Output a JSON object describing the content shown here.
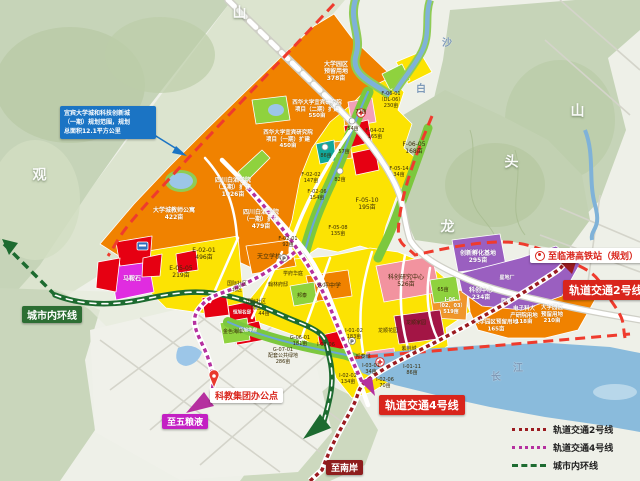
{
  "callout": {
    "text": "宜宾大学城和科技创新城\n（一期）规划范围，规划\n总面积12.1平方公里"
  },
  "labels": {
    "inner_ring": "城市内环线",
    "to_hsr": "至临港高铁站（规划）",
    "line2": "轨道交通2号线",
    "line4": "轨道交通4号线",
    "keji_office": "科教集团办公点",
    "to_wuliangye": "至五粮液",
    "to_nanan": "至南岸"
  },
  "legend": {
    "items": [
      {
        "label": "轨道交通2号线",
        "color": "#9b1b20",
        "style": "dotted"
      },
      {
        "label": "轨道交通4号线",
        "color": "#b5309f",
        "style": "dotted"
      },
      {
        "label": "城市内环线",
        "color": "#1d6b30",
        "style": "dashed"
      }
    ]
  },
  "map": {
    "labels_on_map": [
      {
        "t": "山",
        "x": 240,
        "y": 14,
        "c": "t"
      },
      {
        "t": "观",
        "x": 40,
        "y": 176,
        "c": "t"
      },
      {
        "t": "山",
        "x": 578,
        "y": 112,
        "c": "t"
      },
      {
        "t": "头",
        "x": 512,
        "y": 163,
        "c": "t"
      },
      {
        "t": "龙",
        "x": 448,
        "y": 228,
        "c": "t"
      },
      {
        "t": "沙",
        "x": 447,
        "y": 44,
        "c": "t2"
      },
      {
        "t": "白",
        "x": 421,
        "y": 90,
        "c": "t2"
      },
      {
        "t": "长",
        "x": 496,
        "y": 378,
        "c": "t2"
      },
      {
        "t": "江",
        "x": 518,
        "y": 369,
        "c": "t2"
      },
      {
        "t": "大学园区\n预留用地\n378亩",
        "x": 336,
        "y": 72,
        "c": "w"
      },
      {
        "t": "西华大学宜宾研究院\n项目（二期）扩建\n550亩",
        "x": 317,
        "y": 110,
        "c": "w",
        "fs": 5.5
      },
      {
        "t": "西华大学宜宾研究院\n项目（一期）扩建\n450亩",
        "x": 288,
        "y": 140,
        "c": "w",
        "fs": 5.5
      },
      {
        "t": "四川白酒学院\n（二期）扩建\n1026亩",
        "x": 233,
        "y": 188,
        "c": "w"
      },
      {
        "t": "大学城教师公寓\n422亩",
        "x": 174,
        "y": 214,
        "c": "w"
      },
      {
        "t": "四川白酒学院\n（一期）扩建\n479亩",
        "x": 261,
        "y": 220,
        "c": "w"
      },
      {
        "t": "电子科大\n产研院用地\n118亩",
        "x": 524,
        "y": 316,
        "c": "w",
        "fs": 5.5
      },
      {
        "t": "大学园区\n预留用地\n210亩",
        "x": 552,
        "y": 315,
        "c": "w",
        "fs": 5.5
      },
      {
        "t": "大学园区预留用地\n165亩",
        "x": 496,
        "y": 326,
        "c": "w",
        "fs": 5.5
      },
      {
        "t": "创新孵化基地\n295亩",
        "x": 478,
        "y": 257,
        "c": "w"
      },
      {
        "t": "科创中心\n234亩",
        "x": 481,
        "y": 294,
        "c": "w"
      },
      {
        "t": "星地厂",
        "x": 507,
        "y": 278,
        "c": "w",
        "fs": 5
      },
      {
        "t": "西元",
        "x": 506,
        "y": 301,
        "c": "w",
        "fs": 5
      },
      {
        "t": "马鞍石",
        "x": 132,
        "y": 279,
        "c": "w"
      },
      {
        "t": "恒旭名邸",
        "x": 242,
        "y": 313,
        "c": "w",
        "fs": 4.5
      },
      {
        "t": "恒旭华府",
        "x": 248,
        "y": 331,
        "c": "w",
        "fs": 4.5
      },
      {
        "t": "I-06-\n（02、03）\n519亩",
        "x": 451,
        "y": 306,
        "c": "w",
        "fs": 5
      },
      {
        "t": "天立学校",
        "x": 269,
        "y": 257,
        "c": "d"
      },
      {
        "t": "沙坪中学",
        "x": 329,
        "y": 286,
        "c": "d"
      },
      {
        "t": "学府华庭",
        "x": 293,
        "y": 274,
        "c": "d",
        "fs": 5
      },
      {
        "t": "翰林府邸",
        "x": 278,
        "y": 285,
        "c": "d",
        "fs": 5
      },
      {
        "t": "国际社区\n北区",
        "x": 237,
        "y": 287,
        "c": "d",
        "fs": 5
      },
      {
        "t": "国际社区\n南区",
        "x": 256,
        "y": 305,
        "c": "d",
        "fs": 5
      },
      {
        "t": "44亩",
        "x": 264,
        "y": 314,
        "c": "d",
        "fs": 5
      },
      {
        "t": "邦泰",
        "x": 302,
        "y": 296,
        "c": "d",
        "fs": 5
      },
      {
        "t": "金色海岸",
        "x": 233,
        "y": 332,
        "c": "d",
        "fs": 5
      },
      {
        "t": "E-05-05\n219亩",
        "x": 181,
        "y": 272,
        "c": "d"
      },
      {
        "t": "E-02-01\n496亩",
        "x": 204,
        "y": 254,
        "c": "d"
      },
      {
        "t": "F-02-02\n147亩",
        "x": 311,
        "y": 178,
        "c": "d",
        "fs": 5
      },
      {
        "t": "F-02-06\n154亩",
        "x": 317,
        "y": 195,
        "c": "d",
        "fs": 5
      },
      {
        "t": "F-02-01\n92亩",
        "x": 288,
        "y": 242,
        "c": "d",
        "fs": 5
      },
      {
        "t": "F-04-02\n165亩",
        "x": 375,
        "y": 134,
        "c": "d",
        "fs": 5
      },
      {
        "t": "F-06-01\n（DL-06）\n230亩",
        "x": 391,
        "y": 100,
        "c": "d",
        "fs": 5
      },
      {
        "t": "F-06-05\n168亩",
        "x": 414,
        "y": 148,
        "c": "d"
      },
      {
        "t": "F-05-14\n34亩",
        "x": 399,
        "y": 172,
        "c": "d",
        "fs": 5
      },
      {
        "t": "F-05-10\n195亩",
        "x": 367,
        "y": 204,
        "c": "d"
      },
      {
        "t": "F-05-08\n135亩",
        "x": 338,
        "y": 231,
        "c": "d",
        "fs": 5
      },
      {
        "t": "71亩",
        "x": 361,
        "y": 112,
        "c": "d",
        "fs": 5
      },
      {
        "t": "54亩",
        "x": 353,
        "y": 129,
        "c": "d",
        "fs": 5
      },
      {
        "t": "57亩",
        "x": 344,
        "y": 152,
        "c": "d",
        "fs": 5
      },
      {
        "t": "86亩",
        "x": 326,
        "y": 156,
        "c": "d",
        "fs": 5
      },
      {
        "t": "82亩",
        "x": 340,
        "y": 180,
        "c": "d",
        "fs": 5
      },
      {
        "t": "科创研究中心\n526亩",
        "x": 406,
        "y": 281,
        "c": "d"
      },
      {
        "t": "65亩",
        "x": 443,
        "y": 290,
        "c": "d",
        "fs": 5
      },
      {
        "t": "龙顺家园",
        "x": 416,
        "y": 323,
        "c": "d",
        "fs": 5
      },
      {
        "t": "龙顺花园",
        "x": 388,
        "y": 331,
        "c": "d",
        "fs": 5
      },
      {
        "t": "紫荆城",
        "x": 409,
        "y": 349,
        "c": "d",
        "fs": 5
      },
      {
        "t": "邦泰城",
        "x": 363,
        "y": 357,
        "c": "d",
        "fs": 5
      },
      {
        "t": "I-01-02\n183亩",
        "x": 354,
        "y": 334,
        "c": "d",
        "fs": 5
      },
      {
        "t": "I-01-11\n86亩",
        "x": 412,
        "y": 370,
        "c": "d",
        "fs": 5
      },
      {
        "t": "I-02-02\n134亩",
        "x": 348,
        "y": 379,
        "c": "d",
        "fs": 5
      },
      {
        "t": "I-02-06\n70亩",
        "x": 385,
        "y": 383,
        "c": "d",
        "fs": 5
      },
      {
        "t": "I-03-01\n34亩",
        "x": 371,
        "y": 369,
        "c": "d",
        "fs": 5
      },
      {
        "t": "I-03-06",
        "x": 326,
        "y": 345,
        "c": "d",
        "fs": 5
      },
      {
        "t": "G-06-01\n181亩",
        "x": 300,
        "y": 341,
        "c": "d",
        "fs": 5
      },
      {
        "t": "G-07-01\n配套公共绿地\n286亩",
        "x": 283,
        "y": 356,
        "c": "d",
        "fs": 5
      }
    ]
  }
}
